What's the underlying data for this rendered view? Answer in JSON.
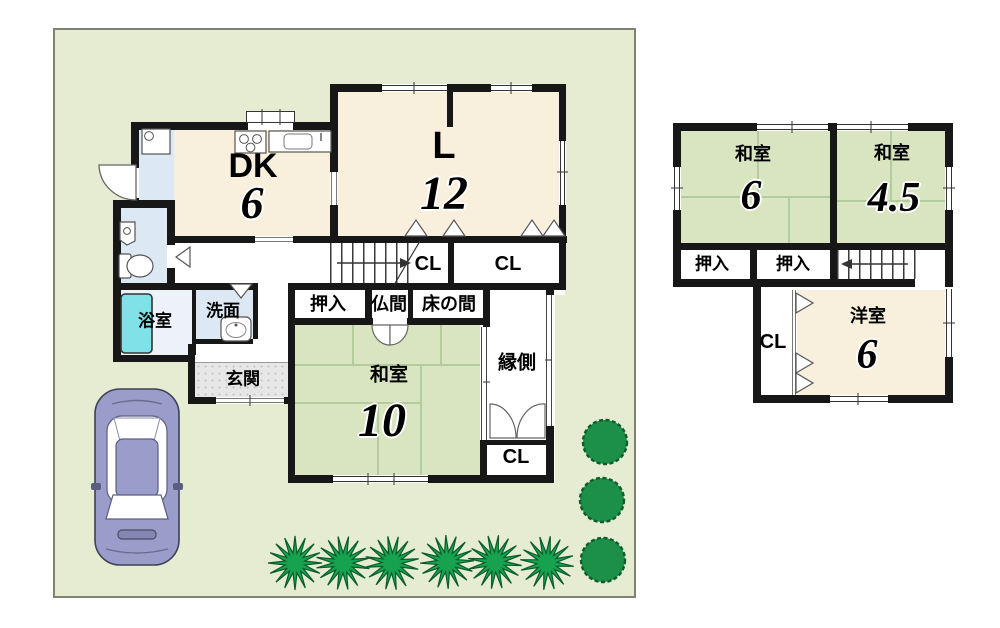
{
  "plan": {
    "type": "japanese-house-floor-plan",
    "palette": {
      "lot_green": "#e5ecd2",
      "tatami_green": "#d9e5c1",
      "wood_cream": "#f9efdd",
      "service_blue": "#dce9f5",
      "bath_tub_cyan": "#7fe2e9",
      "entrance_gray": "#e6e6e6",
      "wall_black": "#171717",
      "bush_green": "#17a24f",
      "car_body_purple": "#9a9cc9"
    }
  },
  "floor1": {
    "dk": {
      "label": "DK",
      "size": "6"
    },
    "living": {
      "label": "L",
      "size": "12"
    },
    "closet_by_stairs": {
      "label": "CL"
    },
    "closet_living": {
      "label": "CL"
    },
    "oshiire": {
      "label": "押入"
    },
    "butsuma": {
      "label": "仏間"
    },
    "tokonoma": {
      "label": "床の間"
    },
    "washitsu": {
      "label": "和室",
      "size": "10"
    },
    "engawa": {
      "label": "縁側"
    },
    "closet_engawa": {
      "label": "CL"
    },
    "bathroom": {
      "label": "浴室"
    },
    "washroom": {
      "label": "洗面"
    },
    "entrance": {
      "label": "玄関"
    }
  },
  "floor2": {
    "washitsu_6": {
      "label": "和室",
      "size": "6"
    },
    "washitsu_45": {
      "label": "和室",
      "size": "4.5"
    },
    "oshiire_left": {
      "label": "押入"
    },
    "oshiire_right": {
      "label": "押入"
    },
    "closet": {
      "label": "CL"
    },
    "yoshitsu": {
      "label": "洋室",
      "size": "6"
    }
  },
  "site": {
    "car": "car-top-view",
    "spiky_bush_count": 6,
    "round_bush_count": 3
  }
}
